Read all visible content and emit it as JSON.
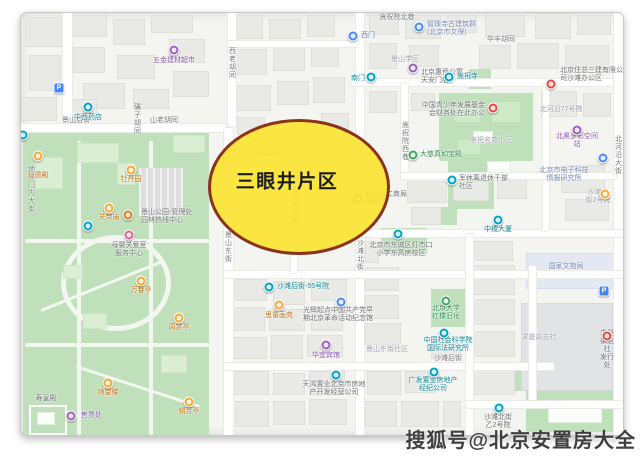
{
  "overlay": {
    "label": "三眼井片区"
  },
  "watermark": {
    "text": "搜狐号@北京安置房大全"
  },
  "colors": {
    "overlay_fill": "rgba(251,227,52,0.93)",
    "overlay_border": "#8a331b",
    "overlay_text": "#1c1c1c",
    "watermark_text": "#3f3f3f",
    "park_green": "#bfe0ba"
  },
  "map": {
    "street_labels": [
      {
        "t": "地安门内大街",
        "x": 10,
        "y": 152,
        "v": true
      },
      {
        "t": "碾子胡同",
        "x": 116,
        "y": 90,
        "v": true
      },
      {
        "t": "西老胡同",
        "x": 211,
        "y": 34,
        "v": true
      },
      {
        "t": "景山后街",
        "x": 55,
        "y": 108
      },
      {
        "t": "山老胡同",
        "x": 143,
        "y": 108
      },
      {
        "t": "景山东街",
        "x": 207,
        "y": 218,
        "v": true
      },
      {
        "t": "沙滩北街",
        "x": 339,
        "y": 226,
        "v": true
      },
      {
        "t": "吉安所左巷",
        "x": 273,
        "y": 172,
        "v": true
      },
      {
        "t": "嵩祝院西巷",
        "x": 384,
        "y": 108,
        "v": true
      },
      {
        "t": "北河沿大街",
        "x": 597,
        "y": 122,
        "v": true
      },
      {
        "t": "嵩祝院北巷",
        "x": 376,
        "y": 5
      },
      {
        "t": "华丰胡同",
        "x": 480,
        "y": 27
      },
      {
        "t": "沙滩后街",
        "x": 427,
        "y": 346
      }
    ],
    "area_labels": [
      {
        "t": "景山学区",
        "x": 384,
        "y": 47
      },
      {
        "t": "嵩祝名苑小区",
        "x": 470,
        "y": 128
      },
      {
        "t": "北河沿77号院",
        "x": 540,
        "y": 97
      },
      {
        "t": "景山东街社区",
        "x": 366,
        "y": 337
      },
      {
        "t": "求是杂志社",
        "x": 518,
        "y": 325
      },
      {
        "t": "三眼井胡同社区",
        "x": 252,
        "y": 142
      },
      {
        "t": "沙滩北街2号院",
        "x": 577,
        "y": 184
      }
    ],
    "poi_labels": [
      {
        "t": "五金建材超市",
        "x": 153,
        "y": 48,
        "c": "purple"
      },
      {
        "t": "中西药店",
        "x": 67,
        "y": 105,
        "c": "teal"
      },
      {
        "t": "西门",
        "x": 340,
        "y": 23,
        "c": "blue",
        "a": "l"
      },
      {
        "t": "智珠寺古建筑群\n(北京市文保)",
        "x": 406,
        "y": 16,
        "c": "blue2",
        "a": "l"
      },
      {
        "t": "南门",
        "x": 344,
        "y": 66,
        "c": "teal",
        "a": "r"
      },
      {
        "t": "北京惠侨公寓\n天安门店",
        "x": 400,
        "y": 64,
        "c": "gray",
        "a": "l"
      },
      {
        "t": "嵩祝寺",
        "x": 436,
        "y": 64,
        "c": "teal",
        "a": "l"
      },
      {
        "t": "北京住总三建有限公\n司沙滩办公区",
        "x": 539,
        "y": 62,
        "c": "gray",
        "a": "l"
      },
      {
        "t": "北奥多彩空间站",
        "x": 556,
        "y": 128,
        "c": "purple"
      },
      {
        "t": "中国青少年发展基金\n会财务处在此办公",
        "x": 464,
        "y": 97,
        "c": "gray",
        "a": "r"
      },
      {
        "t": "大慈真如宝殿",
        "x": 399,
        "y": 142,
        "c": "green",
        "a": "l"
      },
      {
        "t": "军休离退休干部\n社区",
        "x": 438,
        "y": 170,
        "c": "gray",
        "a": "l"
      },
      {
        "t": "北京市电子科技\n情报研究所",
        "x": 543,
        "y": 162,
        "c": "blue2"
      },
      {
        "t": "中稷大厦",
        "x": 477,
        "y": 217,
        "c": "teal"
      },
      {
        "t": "北京市二商局\n宿舍区",
        "x": 344,
        "y": 186,
        "c": "gray",
        "a": "l"
      },
      {
        "t": "北京市东城区灯市口\n小学东高房校区",
        "x": 380,
        "y": 237,
        "c": "gray"
      },
      {
        "t": "沙滩后街-55号院",
        "x": 256,
        "y": 274,
        "c": "teal",
        "a": "l"
      },
      {
        "t": "思童画苑",
        "x": 258,
        "y": 303,
        "c": "orange"
      },
      {
        "t": "光辉起点中国共产党早\n期北京革命活动纪念馆",
        "x": 317,
        "y": 302,
        "c": "gray"
      },
      {
        "t": "北京大学\n红楼旧址",
        "x": 425,
        "y": 300,
        "c": "green"
      },
      {
        "t": "中国社会科学院\n国际法研究所",
        "x": 427,
        "y": 332,
        "c": "teal"
      },
      {
        "t": "华宜宾馆",
        "x": 305,
        "y": 343,
        "c": "purple"
      },
      {
        "t": "天鸿置业北京市房地\n产开发经营公司",
        "x": 313,
        "y": 376,
        "c": "gray"
      },
      {
        "t": "广发置业房地产\n经纪公司",
        "x": 412,
        "y": 372,
        "c": "teal"
      },
      {
        "t": "求是杂志社\n发行处",
        "x": 586,
        "y": 337,
        "c": "gray"
      },
      {
        "t": "沙滩北街\n乙2号院",
        "x": 477,
        "y": 409,
        "c": "gray"
      },
      {
        "t": "国家文物局",
        "x": 545,
        "y": 254,
        "c": "blue2"
      },
      {
        "t": "观德殿",
        "x": 17,
        "y": 163,
        "c": "orange"
      },
      {
        "t": "牡丹园",
        "x": 110,
        "y": 167,
        "c": "orange"
      },
      {
        "t": "关帝庙",
        "x": 88,
        "y": 205,
        "c": "orange"
      },
      {
        "t": "万春亭",
        "x": 120,
        "y": 278,
        "c": "orange"
      },
      {
        "t": "周赏亭",
        "x": 158,
        "y": 315,
        "c": "orange"
      },
      {
        "t": "绮望楼",
        "x": 87,
        "y": 380,
        "c": "orange"
      },
      {
        "t": "辑芳亭",
        "x": 168,
        "y": 399,
        "c": "orange"
      },
      {
        "t": "售票处",
        "x": 60,
        "y": 403,
        "c": "purple",
        "a": "l"
      },
      {
        "t": "寿皇殿",
        "x": 25,
        "y": 386,
        "c": "gray"
      },
      {
        "t": "景山公园-管理处\n园林热线中心",
        "x": 120,
        "y": 204,
        "c": "gray",
        "a": "l"
      },
      {
        "t": "母婴关爱室\n服务中心",
        "x": 108,
        "y": 237,
        "c": "gray"
      }
    ],
    "markers": [
      {
        "x": 38,
        "y": 75,
        "k": "p",
        "n": "parking-pin"
      },
      {
        "x": 583,
        "y": 278,
        "k": "p",
        "n": "parking-pin"
      },
      {
        "x": 153,
        "y": 37,
        "k": "purple",
        "n": "shop-pin"
      },
      {
        "x": 67,
        "y": 94,
        "k": "teal",
        "n": "pharmacy-pin"
      },
      {
        "x": 332,
        "y": 23,
        "k": "blue",
        "n": "gate-pin"
      },
      {
        "x": 398,
        "y": 14,
        "k": "blue",
        "n": "temple-pin"
      },
      {
        "x": 392,
        "y": 55,
        "k": "purple",
        "n": "hotel-pin"
      },
      {
        "x": 350,
        "y": 64,
        "k": "teal",
        "n": "gate-pin"
      },
      {
        "x": 428,
        "y": 64,
        "k": "teal",
        "n": "temple-pin"
      },
      {
        "x": 530,
        "y": 71,
        "k": "red",
        "n": "office-pin"
      },
      {
        "x": 556,
        "y": 117,
        "k": "purple",
        "n": "poi-pin"
      },
      {
        "x": 472,
        "y": 95,
        "k": "red",
        "n": "office-pin"
      },
      {
        "x": 392,
        "y": 142,
        "k": "green",
        "n": "hall-pin"
      },
      {
        "x": 431,
        "y": 167,
        "k": "teal",
        "n": "community-pin"
      },
      {
        "x": 582,
        "y": 145,
        "k": "blue",
        "n": "poi-pin"
      },
      {
        "x": 584,
        "y": 181,
        "k": "orange",
        "n": "poi-pin"
      },
      {
        "x": 477,
        "y": 207,
        "k": "teal",
        "n": "building-pin"
      },
      {
        "x": 337,
        "y": 185,
        "k": "purple",
        "n": "dormitory-pin"
      },
      {
        "x": 377,
        "y": 221,
        "k": "teal",
        "n": "school-pin"
      },
      {
        "x": 248,
        "y": 274,
        "k": "teal",
        "n": "courtyard-pin"
      },
      {
        "x": 258,
        "y": 292,
        "k": "orange",
        "n": "art-pin"
      },
      {
        "x": 320,
        "y": 289,
        "k": "blue",
        "n": "museum-pin"
      },
      {
        "x": 425,
        "y": 288,
        "k": "green",
        "n": "heritage-pin"
      },
      {
        "x": 423,
        "y": 320,
        "k": "teal",
        "n": "institute-pin"
      },
      {
        "x": 305,
        "y": 332,
        "k": "purple",
        "n": "hotel-pin"
      },
      {
        "x": 315,
        "y": 362,
        "k": "teal",
        "n": "company-pin"
      },
      {
        "x": 413,
        "y": 359,
        "k": "teal",
        "n": "company-pin"
      },
      {
        "x": 586,
        "y": 323,
        "k": "red",
        "n": "office-pin"
      },
      {
        "x": 478,
        "y": 395,
        "k": "teal",
        "n": "courtyard-pin"
      },
      {
        "x": 17,
        "y": 143,
        "k": "orange",
        "n": "park-poi-pin"
      },
      {
        "x": 110,
        "y": 157,
        "k": "orange",
        "n": "park-poi-pin"
      },
      {
        "x": 88,
        "y": 195,
        "k": "orange",
        "n": "park-poi-pin"
      },
      {
        "x": 107,
        "y": 202,
        "k": "dorange",
        "n": "park-office-pin"
      },
      {
        "x": 108,
        "y": 222,
        "k": "pink",
        "n": "service-pin"
      },
      {
        "x": 120,
        "y": 268,
        "k": "orange",
        "n": "pavilion-pin"
      },
      {
        "x": 158,
        "y": 305,
        "k": "orange",
        "n": "pavilion-pin"
      },
      {
        "x": 87,
        "y": 370,
        "k": "orange",
        "n": "pavilion-pin"
      },
      {
        "x": 168,
        "y": 389,
        "k": "orange",
        "n": "pavilion-pin"
      },
      {
        "x": 50,
        "y": 403,
        "k": "purple",
        "n": "ticket-pin"
      },
      {
        "x": 67,
        "y": 213,
        "k": "teal",
        "n": "gate-pin"
      },
      {
        "x": 2,
        "y": 122,
        "k": "teal",
        "n": "gate-pin"
      }
    ]
  }
}
